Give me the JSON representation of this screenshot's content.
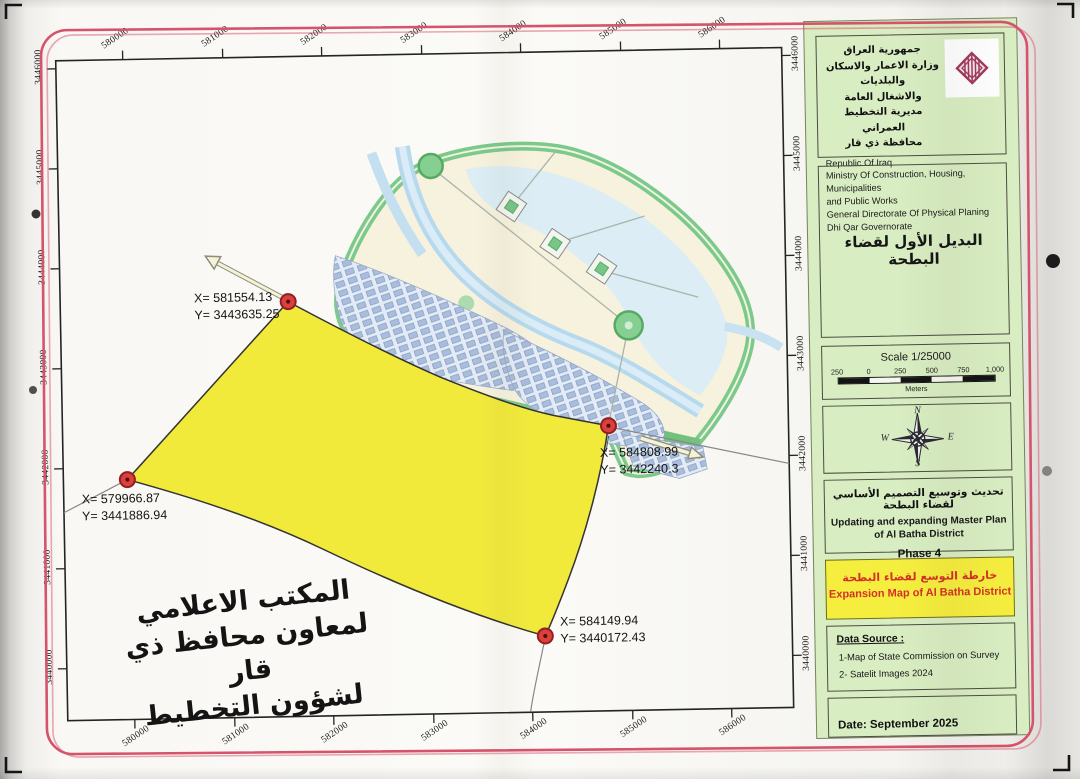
{
  "header_panel": {
    "arabic_lines": [
      "جمهورية العراق",
      "وزارة الاعمار والاسكان والبلديات",
      "والاشغال العامة",
      "مديرية التخطيط العمراني",
      "محافظة ذي قار"
    ],
    "english_lines": [
      "Republic Of Iraq",
      "Ministry Of Construction, Housing, Municipalities",
      "and Public Works",
      "General Directorate Of Physical Planing",
      "Dhi Qar Governorate"
    ]
  },
  "alternative_box": {
    "arabic_title": "البديل الأول لقضاء البطحة"
  },
  "scale_box": {
    "title": "Scale 1/25000",
    "tick_labels": [
      "250",
      "0",
      "250",
      "500",
      "750",
      "1,000"
    ],
    "unit": "Meters"
  },
  "compass": {
    "north": "N",
    "east": "E",
    "south": "S",
    "west": "W"
  },
  "master_plan_box": {
    "arabic": "تحديث وتوسيع التصميم الأساسي لقضاء البطحة",
    "english_line1": "Updating and expanding Master Plan",
    "english_line2": "of Al Batha District",
    "phase": "Phase 4"
  },
  "expansion_box": {
    "arabic": "خارطة التوسع لقضاء البطحة",
    "english": "Expansion Map of Al Batha District"
  },
  "data_source_box": {
    "title": "Data Source :",
    "items": [
      "1-Map of State Commission on Survey",
      "2- Satelit Images 2024"
    ]
  },
  "date_box": {
    "text": "Date: September 2025"
  },
  "map": {
    "axes": {
      "x_labels": [
        "580000",
        "581000",
        "582000",
        "583000",
        "584000",
        "585000",
        "586000"
      ],
      "y_labels": [
        "3446000",
        "3445000",
        "3444000",
        "3443000",
        "3442000",
        "3441000",
        "3440000"
      ]
    },
    "points": [
      {
        "x_label": "X= 581554.13",
        "y_label": "Y= 3443635.25"
      },
      {
        "x_label": "X= 579966.87",
        "y_label": "Y= 3441886.94"
      },
      {
        "x_label": "X= 584808.99",
        "y_label": "Y= 3442240.3"
      },
      {
        "x_label": "X= 584149.94",
        "y_label": "Y= 3440172.43"
      }
    ]
  },
  "watermark": {
    "lines": [
      "المكتب الاعلامي",
      "لمعاون محافظ ذي قار",
      "لشؤون التخطيط"
    ]
  },
  "colors": {
    "expansion_yellow": "#f2ea3b",
    "panel_green": "#d9edc2",
    "border_red": "#d5536b",
    "point_red": "#dd3f3a",
    "logo_maroon": "#a23a5d"
  }
}
